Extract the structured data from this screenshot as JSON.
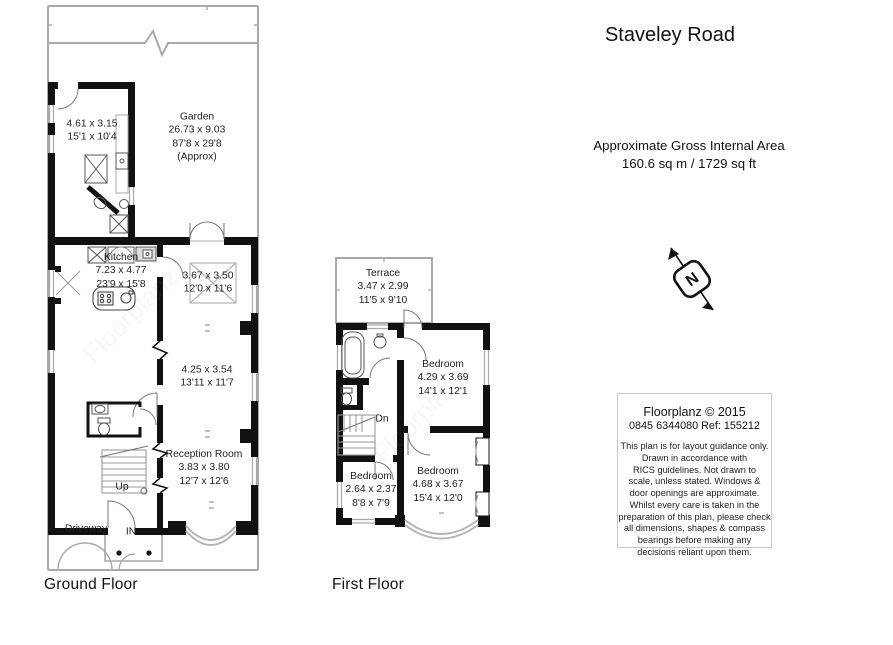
{
  "title": "Staveley Road",
  "area": {
    "label": "Approximate Gross Internal Area",
    "value": "160.6 sq m / 1729 sq ft"
  },
  "compass": {
    "letter": "N"
  },
  "info_box": {
    "company": "Floorplanz © 2015",
    "phone_ref": "0845 6344080 Ref: 155212",
    "disclaimer": [
      "This plan is for layout guidance only.",
      "Drawn in accordance with",
      "RICS guidelines. Not drawn to",
      "scale, unless stated. Windows &",
      "door openings are approximate.",
      "Whilst every care is taken in the",
      "preparation of this plan, please check",
      "all dimensions, shapes & compass",
      "bearings before making any",
      "decisions reliant upon them."
    ]
  },
  "watermark": "Floorplanz",
  "ground_floor": {
    "label": "Ground Floor",
    "rooms": {
      "garden": {
        "name": "Garden",
        "metric": "26.73 x 9.03",
        "imperial": "87'8 x 29'8",
        "approx": "(Approx)"
      },
      "outbuilding": {
        "metric": "4.61 x 3.15",
        "imperial": "15'1 x 10'4"
      },
      "kitchen": {
        "name": "Kitchen",
        "metric": "7.23 x 4.77",
        "imperial": "23'9 x 15'8"
      },
      "garden_room": {
        "metric": "3.67 x 3.50",
        "imperial": "12'0 x 11'6"
      },
      "dining_room": {
        "metric": "4.25 x 3.54",
        "imperial": "13'11 x 11'7"
      },
      "reception_room": {
        "name": "Reception Room",
        "metric": "3.83 x 3.80",
        "imperial": "12'7 x 12'6"
      }
    },
    "annotations": {
      "up": "Up",
      "driveway": "Driveway",
      "entrance": "IN"
    }
  },
  "first_floor": {
    "label": "First Floor",
    "rooms": {
      "terrace": {
        "name": "Terrace",
        "metric": "3.47 x 2.99",
        "imperial": "11'5 x 9'10"
      },
      "bedroom_rear": {
        "name": "Bedroom",
        "metric": "4.29 x 3.69",
        "imperial": "14'1 x 12'1"
      },
      "bedroom_small": {
        "name": "Bedroom",
        "metric": "2.64 x 2.37",
        "imperial": "8'8 x 7'9"
      },
      "bedroom_front": {
        "name": "Bedroom",
        "metric": "4.68 x 3.67",
        "imperial": "15'4 x 12'0"
      }
    },
    "annotations": {
      "down": "Dn"
    }
  },
  "colors": {
    "wall": "#111111",
    "boundary": "#a9a9a9",
    "text": "#1a1a1a"
  }
}
